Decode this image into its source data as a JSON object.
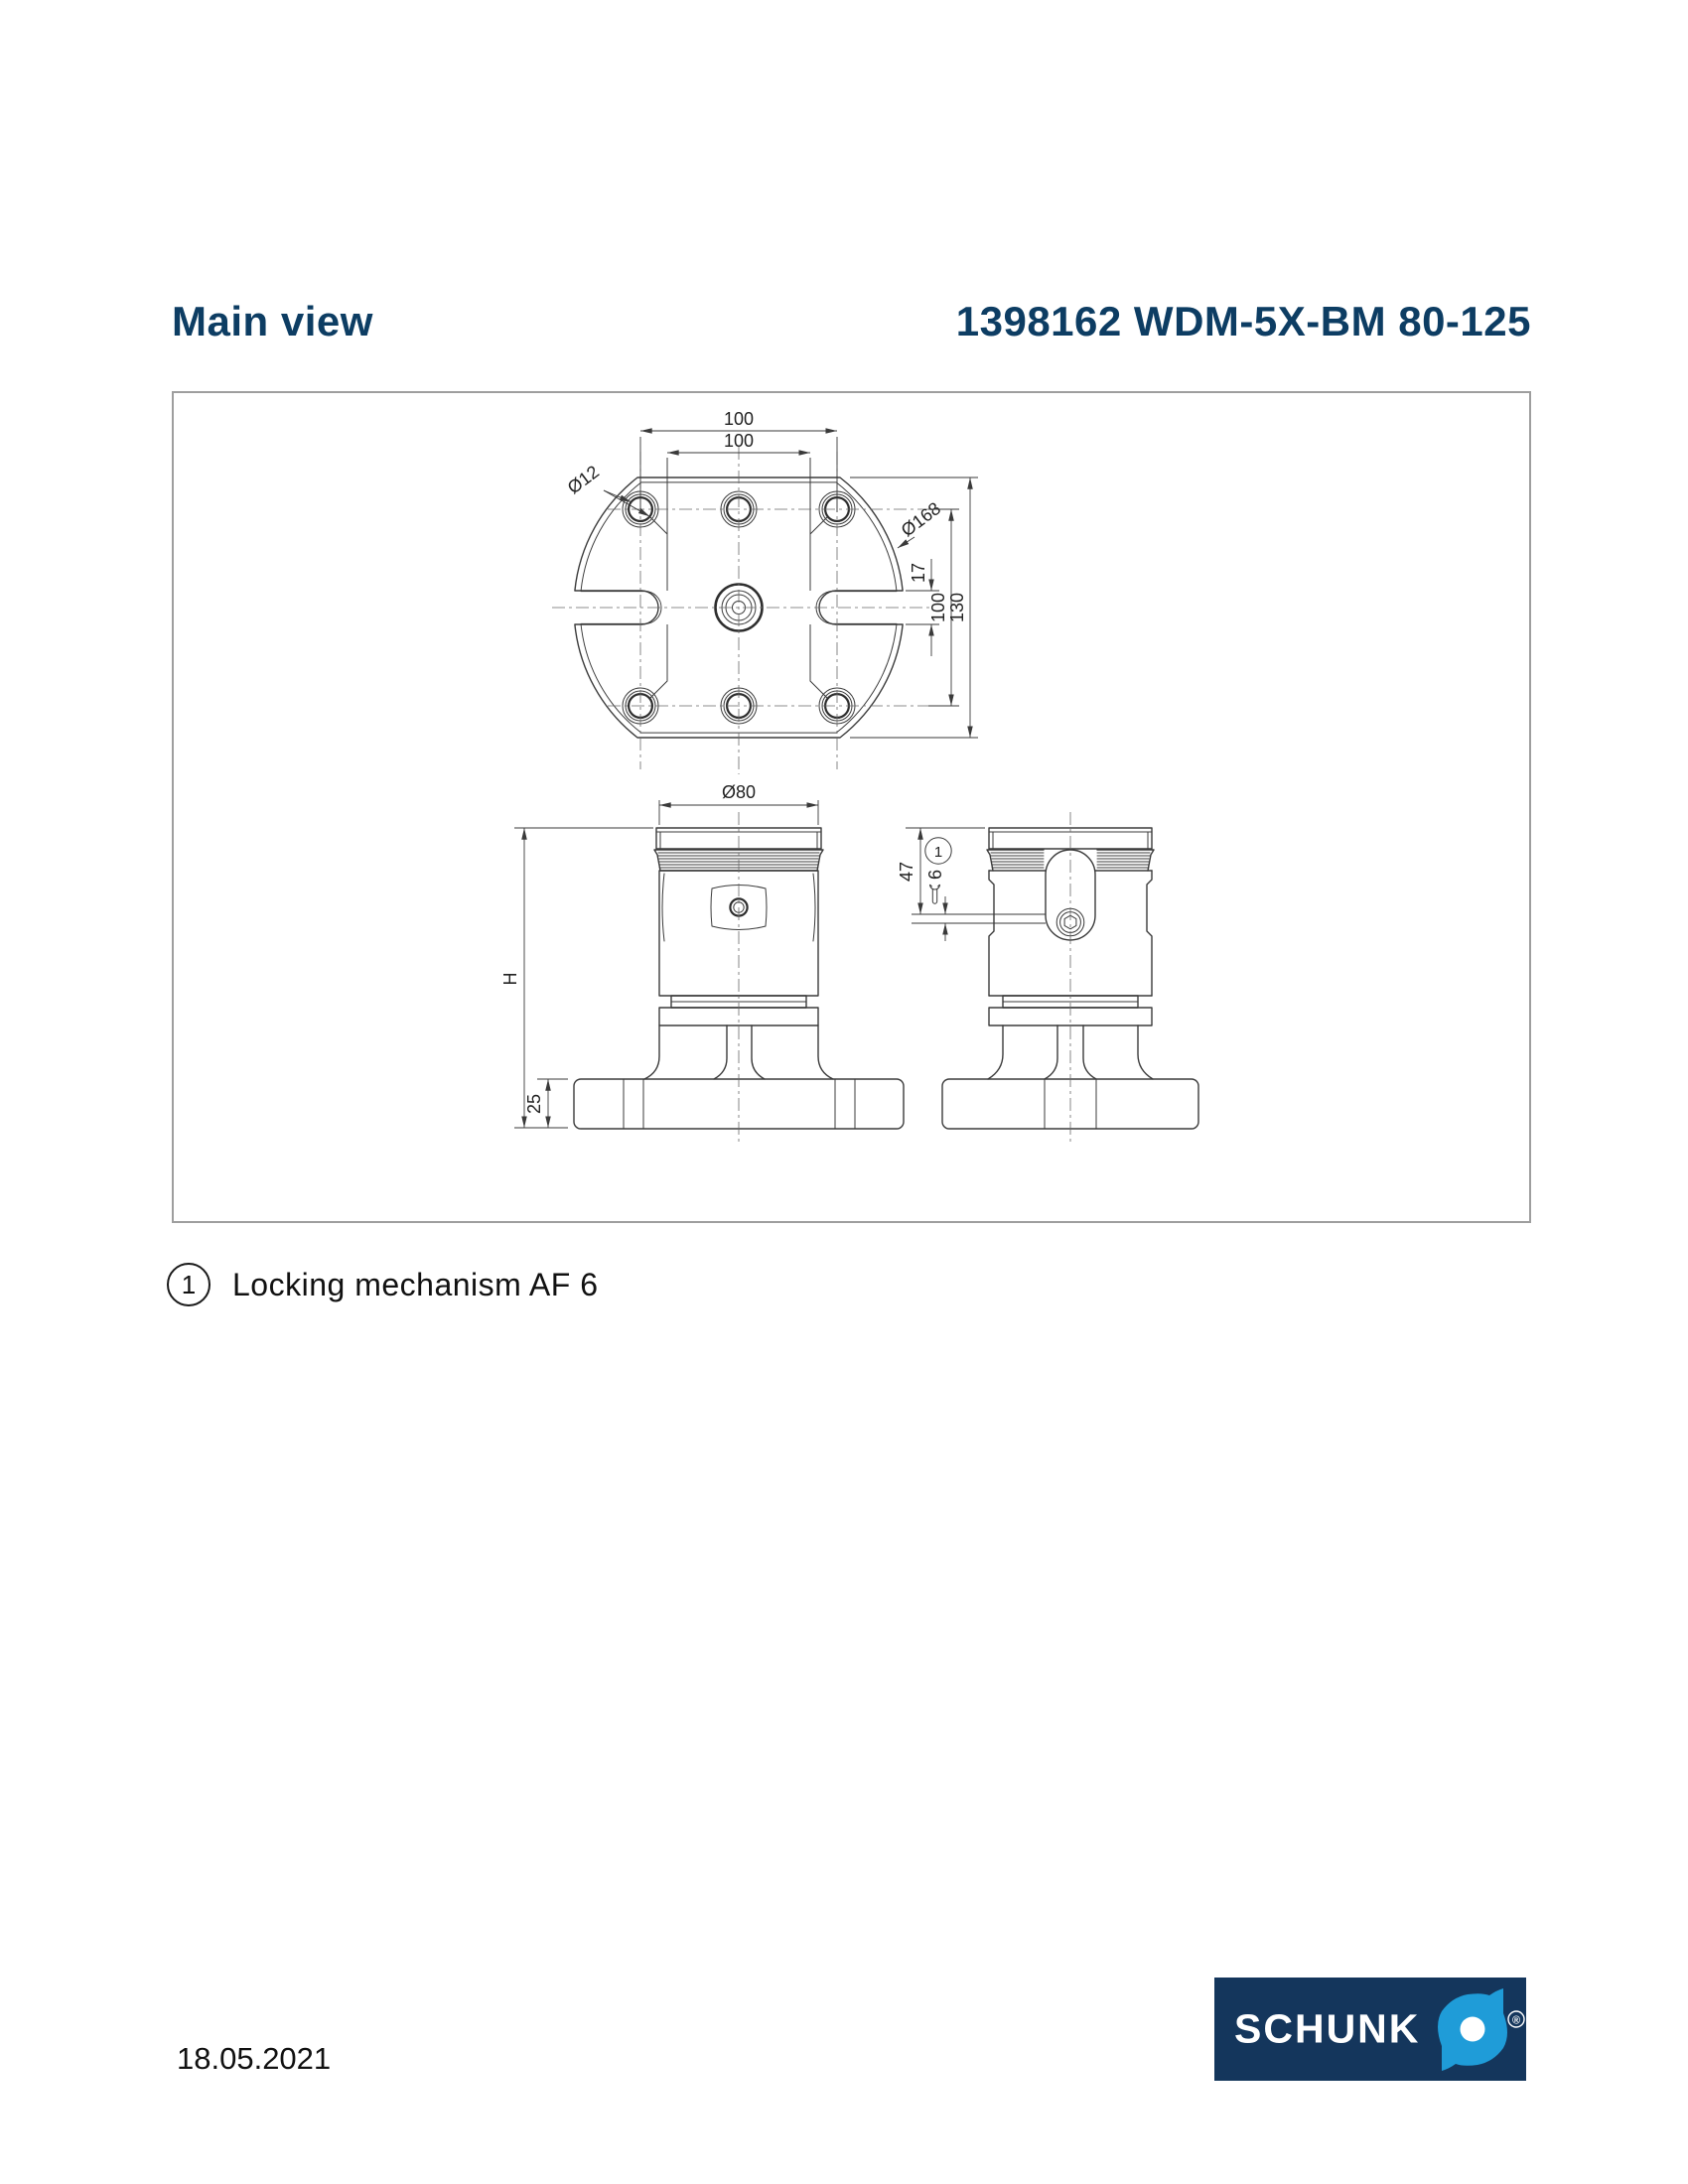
{
  "header": {
    "title_left": "Main view",
    "title_right": "1398162 WDM-5X-BM 80-125"
  },
  "drawing": {
    "top_view": {
      "dim_span_outer": "100",
      "dim_span_inner": "100",
      "dim_hole_dia": "Ø12",
      "dim_outer_dia": "Ø168",
      "dim_slot_height": "17",
      "dim_row_spacing": "100",
      "dim_overall_height": "130"
    },
    "front_view": {
      "dim_dia": "Ø80",
      "dim_height": "H",
      "dim_base_height": "25"
    },
    "side_view": {
      "dim_top_to_lock": "47",
      "dim_lock_size": "6",
      "callout_number": "1"
    }
  },
  "legend": {
    "marker": "1",
    "text": "Locking mechanism AF 6"
  },
  "footer": {
    "date": "18.05.2021",
    "logo_text": "SCHUNK",
    "logo_reg": "®"
  },
  "colors": {
    "accent_navy": "#0d3d63",
    "logo_bg": "#14365c",
    "logo_blue": "#1f9cd8",
    "frame_gray": "#9e9e9e"
  }
}
